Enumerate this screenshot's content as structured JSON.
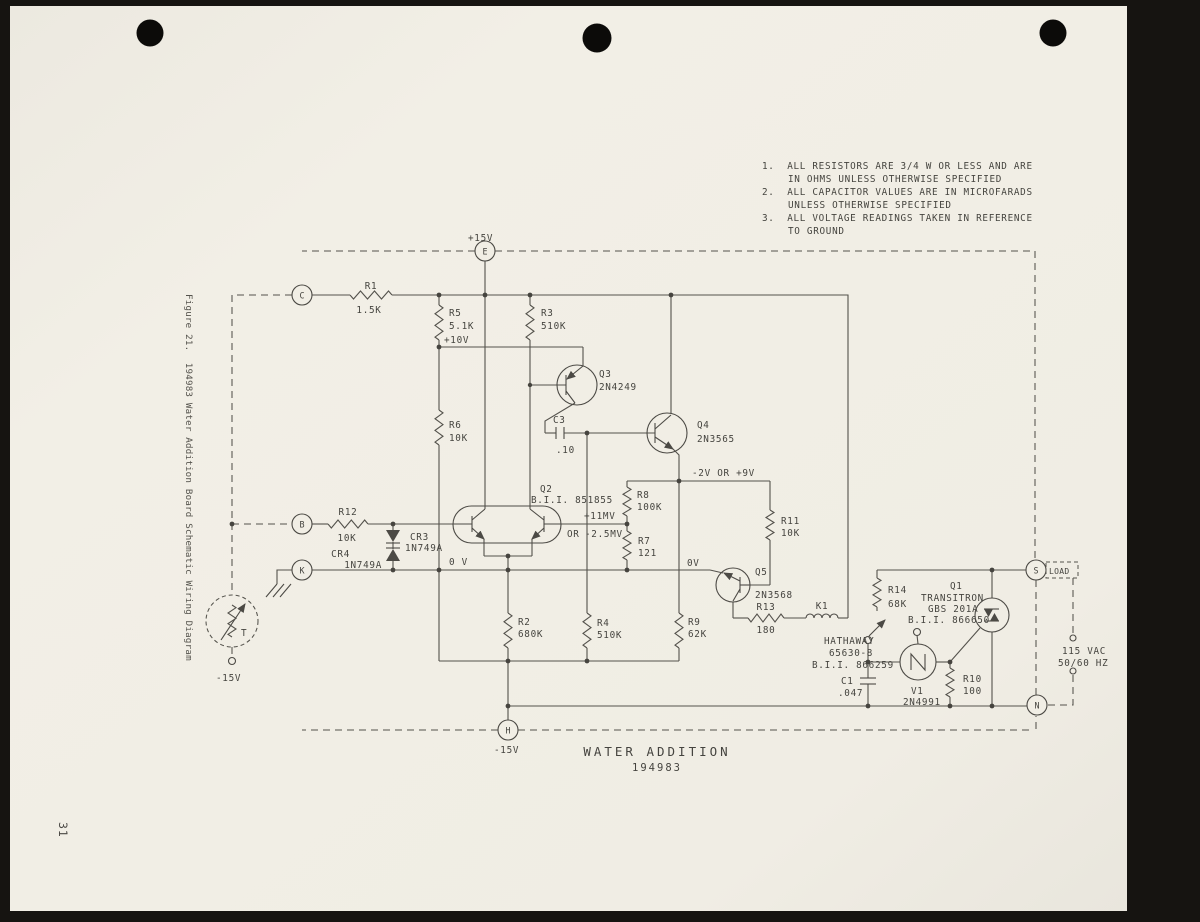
{
  "page": {
    "number": "31",
    "caption": "Figure 21.  194983 Water Addition Board Schematic Wiring Diagram"
  },
  "title": {
    "name": "WATER ADDITION",
    "number": "194983"
  },
  "notes": [
    "1.  ALL RESISTORS ARE 3/4 W OR LESS AND ARE",
    "IN OHMS UNLESS OTHERWISE SPECIFIED",
    "2.  ALL CAPACITOR VALUES ARE IN MICROFARADS",
    "UNLESS OTHERWISE SPECIFIED",
    "3.  ALL VOLTAGE READINGS TAKEN IN REFERENCE",
    "TO GROUND"
  ],
  "terminals": {
    "e": "E",
    "c": "C",
    "b": "B",
    "k": "K",
    "h": "H",
    "s": "S",
    "n": "N",
    "load": "LOAD"
  },
  "nets": {
    "p15": "+15V",
    "p10": "+10V",
    "m15_h": "-15V",
    "m15_probe": "-15V",
    "ov_left": "0 V",
    "ov_right": "0V",
    "q4_node": "-2V OR +9V",
    "mv_pos": "+11MV",
    "mv_or": "OR",
    "mv_neg": "-2.5MV",
    "ac1": "115 VAC",
    "ac2": "50/60 HZ",
    "probe_t": "T"
  },
  "components": {
    "r1": {
      "ref": "R1",
      "val": "1.5K"
    },
    "r2": {
      "ref": "R2",
      "val": "680K"
    },
    "r3": {
      "ref": "R3",
      "val": "510K"
    },
    "r4": {
      "ref": "R4",
      "val": "510K"
    },
    "r5": {
      "ref": "R5",
      "val": "5.1K"
    },
    "r6": {
      "ref": "R6",
      "val": "10K"
    },
    "r7": {
      "ref": "R7",
      "val": "121"
    },
    "r8": {
      "ref": "R8",
      "val": "100K"
    },
    "r9": {
      "ref": "R9",
      "val": "62K"
    },
    "r10": {
      "ref": "R10",
      "val": "100"
    },
    "r11": {
      "ref": "R11",
      "val": "10K"
    },
    "r12": {
      "ref": "R12",
      "val": "10K"
    },
    "r13": {
      "ref": "R13",
      "val": "180"
    },
    "r14": {
      "ref": "R14",
      "val": "68K"
    },
    "c1": {
      "ref": "C1",
      "val": ".047"
    },
    "c3": {
      "ref": "C3",
      "val": ".10"
    },
    "cr3": {
      "ref": "CR3",
      "val": "1N749A"
    },
    "cr4": {
      "ref": "CR4",
      "val": "1N749A"
    },
    "q1": {
      "ref": "Q1",
      "mfr": "TRANSITRON",
      "part": "GBS 201A",
      "bii": "B.I.I. 866650"
    },
    "q2": {
      "ref": "Q2",
      "bii": "B.I.I. 851855"
    },
    "q3": {
      "ref": "Q3",
      "part": "2N4249"
    },
    "q4": {
      "ref": "Q4",
      "part": "2N3565"
    },
    "q5": {
      "ref": "Q5",
      "part": "2N3568"
    },
    "v1": {
      "ref": "V1",
      "part": "2N4991"
    },
    "k1": {
      "ref": "K1",
      "mfr": "HATHAWAY",
      "part": "65630-8",
      "bii": "B.I.I. 866259"
    }
  },
  "colors": {
    "paper": "#f1eee5",
    "ink": "#54524c",
    "background": "#161411"
  }
}
